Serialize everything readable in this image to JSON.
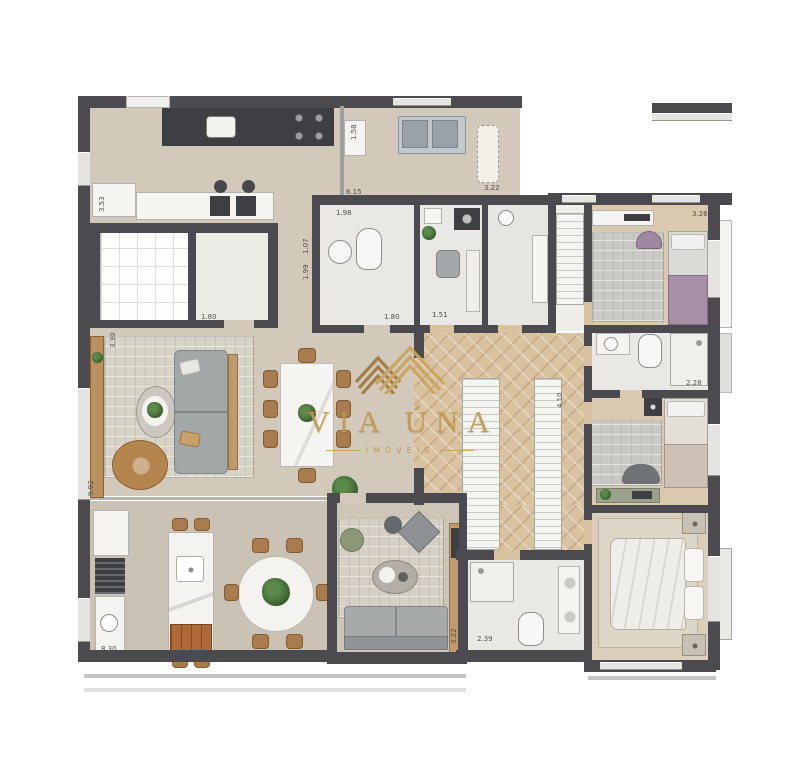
{
  "watermark": {
    "brand": "VIA ÚNA",
    "tagline": "IMÓVEIS"
  },
  "colors": {
    "wall": "#4b4b4f",
    "floor_living": "#d3c9ba",
    "floor_terrace": "#c9c2b5",
    "floor_wood_herringbone": "#d8c2a0",
    "floor_bathroom": "#eae8e4",
    "watermark_gold": "#c09a52",
    "bed_blanket_purple": "#a78fa7",
    "sofa_gray": "#a2a7a8",
    "wood_furniture": "#b9905e"
  },
  "dimensions": [
    {
      "x": 346,
      "y": 189,
      "text": "6.15",
      "vertical": false
    },
    {
      "x": 336,
      "y": 210,
      "text": "1.98",
      "vertical": false
    },
    {
      "x": 303,
      "y": 254,
      "text": "1.07",
      "vertical": true
    },
    {
      "x": 303,
      "y": 280,
      "text": "1.99",
      "vertical": true
    },
    {
      "x": 99,
      "y": 212,
      "text": "3.53",
      "vertical": true
    },
    {
      "x": 351,
      "y": 140,
      "text": "1.58",
      "vertical": true
    },
    {
      "x": 201,
      "y": 314,
      "text": "1.80",
      "vertical": false
    },
    {
      "x": 384,
      "y": 314,
      "text": "1.80",
      "vertical": false
    },
    {
      "x": 432,
      "y": 312,
      "text": "1.51",
      "vertical": false
    },
    {
      "x": 484,
      "y": 185,
      "text": "3.22",
      "vertical": false
    },
    {
      "x": 692,
      "y": 211,
      "text": "3.26",
      "vertical": false
    },
    {
      "x": 686,
      "y": 380,
      "text": "2.28",
      "vertical": false
    },
    {
      "x": 451,
      "y": 644,
      "text": "3.22",
      "vertical": true
    },
    {
      "x": 477,
      "y": 636,
      "text": "2.39",
      "vertical": false
    },
    {
      "x": 101,
      "y": 646,
      "text": "8.30",
      "vertical": false
    },
    {
      "x": 88,
      "y": 496,
      "text": "9.92",
      "vertical": true
    },
    {
      "x": 110,
      "y": 348,
      "text": "3.30",
      "vertical": true
    },
    {
      "x": 557,
      "y": 408,
      "text": "4.10",
      "vertical": true
    }
  ]
}
